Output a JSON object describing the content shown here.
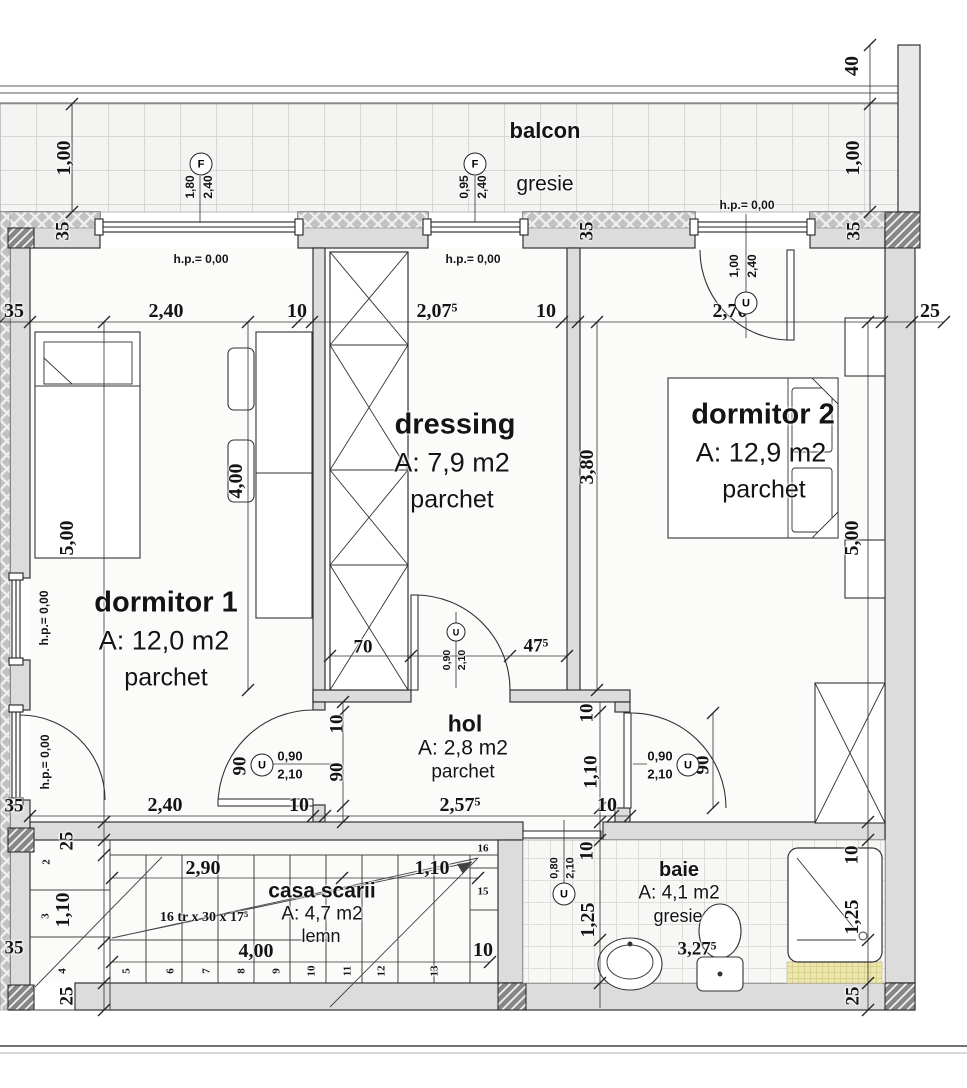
{
  "rooms": {
    "balcon": {
      "name": "balcon",
      "finish": "gresie"
    },
    "dormitor1": {
      "name": "dormitor 1",
      "area": "A: 12,0 m2",
      "finish": "parchet"
    },
    "dressing": {
      "name": "dressing",
      "area": "A: 7,9 m2",
      "finish": "parchet"
    },
    "dormitor2": {
      "name": "dormitor 2",
      "area": "A: 12,9 m2",
      "finish": "parchet"
    },
    "hol": {
      "name": "hol",
      "area": "A: 2,8 m2",
      "finish": "parchet"
    },
    "casa_scarii": {
      "name": "casa scarii",
      "area": "A: 4,7 m2",
      "finish": "lemn",
      "stair_spec": "16 tr x 30 x 17⁵"
    },
    "baie": {
      "name": "baie",
      "area": "A: 4,1 m2",
      "finish": "gresie"
    }
  },
  "hp_label": "h.p.= 0,00",
  "openings": {
    "window_f1": {
      "tag": "F",
      "width": "1,80",
      "height": "2,40"
    },
    "window_f2": {
      "tag": "F",
      "width": "0,95",
      "height": "2,40"
    },
    "door_balcony": {
      "tag": "U",
      "width": "1,00",
      "height": "2,40"
    },
    "door_dressing": {
      "tag": "U",
      "width": "0,90",
      "height": "2,10"
    },
    "door_dormitor1": {
      "tag": "U",
      "width": "0,90",
      "height": "2,10"
    },
    "door_dormitor2": {
      "tag": "U",
      "width": "0,90",
      "height": "2,10"
    },
    "door_baie": {
      "tag": "U",
      "width": "0,80",
      "height": "2,10"
    }
  },
  "dims": {
    "parapet_40": "40",
    "balcony_left": "1,00",
    "balcony_right": "1,00",
    "top_wall_left": "35",
    "top_wall_mid": "35",
    "top_wall_right": "35",
    "row_top": [
      "35",
      "2,40",
      "10",
      "2,07⁵",
      "10",
      "2,70",
      "25"
    ],
    "dorm1_len": "5,00",
    "dorm1_inner": "4,00",
    "dressing_len": "3,80",
    "dorm2_len": "5,00",
    "wardrobe_w": "70",
    "dressing_door_off": "47⁵",
    "hol_l10": "10",
    "hol_l90": "90",
    "door1_90": "90",
    "hol_r10": "10",
    "hol_r110": "1,10",
    "door2_90": "90",
    "row_bottom": [
      "2,40",
      "10",
      "2,57⁵",
      "10"
    ],
    "left_35a": "35",
    "left_25a": "25",
    "left_110": "1,10",
    "left_35b": "35",
    "left_25b": "25",
    "stair_290": "2,90",
    "stair_110": "1,10",
    "stair_400": "4,00",
    "stair_w10": "10",
    "baie_10": "10",
    "baie_125": "1,25",
    "baie_w": "3,27⁵",
    "right_10": "10",
    "right_125": "1,25",
    "right_25": "25"
  },
  "stair_numbers": [
    "2",
    "3",
    "4",
    "5",
    "6",
    "7",
    "8",
    "9",
    "10",
    "11",
    "12",
    "13",
    "15",
    "16"
  ]
}
